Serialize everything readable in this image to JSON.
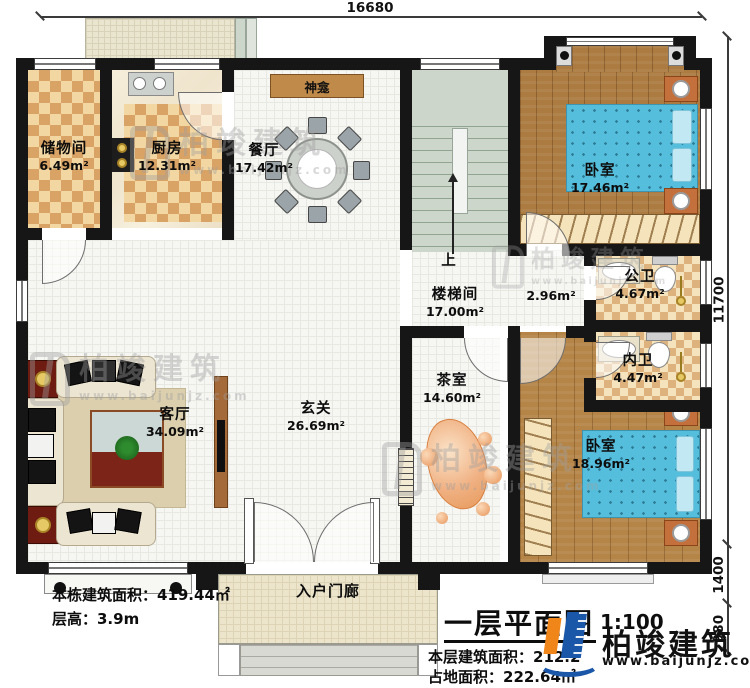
{
  "dims": {
    "width": "16680",
    "height": "11700",
    "porch_depth": "1400",
    "steps_depth": "980"
  },
  "rooms": {
    "storage": {
      "name": "储物间",
      "area": "6.49m²"
    },
    "kitchen": {
      "name": "厨房",
      "area": "12.31m²"
    },
    "dining": {
      "name": "餐厅",
      "area": "17.42m²"
    },
    "shrine": {
      "name": "神龛"
    },
    "bedroom1": {
      "name": "卧室",
      "area": "17.46m²"
    },
    "stair": {
      "name": "楼梯间",
      "area": "17.00m²",
      "up": "上",
      "landing_area": "2.96m²"
    },
    "public_bath": {
      "name": "公卫",
      "area": "4.67m²"
    },
    "private_bath": {
      "name": "内卫",
      "area": "4.47m²"
    },
    "tea": {
      "name": "茶室",
      "area": "14.60m²"
    },
    "foyer": {
      "name": "玄关",
      "area": "26.69m²"
    },
    "living": {
      "name": "客厅",
      "area": "34.09m²"
    },
    "bedroom2": {
      "name": "卧室",
      "area": "18.96m²"
    },
    "porch": {
      "name": "入户门廊"
    }
  },
  "notes": {
    "total_area": "本栋建筑面积：419.44㎡",
    "floor_height": "层高：3.9m",
    "title": "一层平面图",
    "scale": "1:100",
    "floor_area": "本层建筑面积：212.2",
    "footprint": "占地面积：222.64㎡"
  },
  "brand": {
    "name": "柏竣建筑",
    "url": "www.baijunjz.com"
  },
  "colors": {
    "wall": "#161616",
    "bed": "#56bedd",
    "wood": "#ab7b41",
    "checker": "#d9a365",
    "logo_blue": "#1a57a8",
    "logo_orange": "#f08519"
  }
}
